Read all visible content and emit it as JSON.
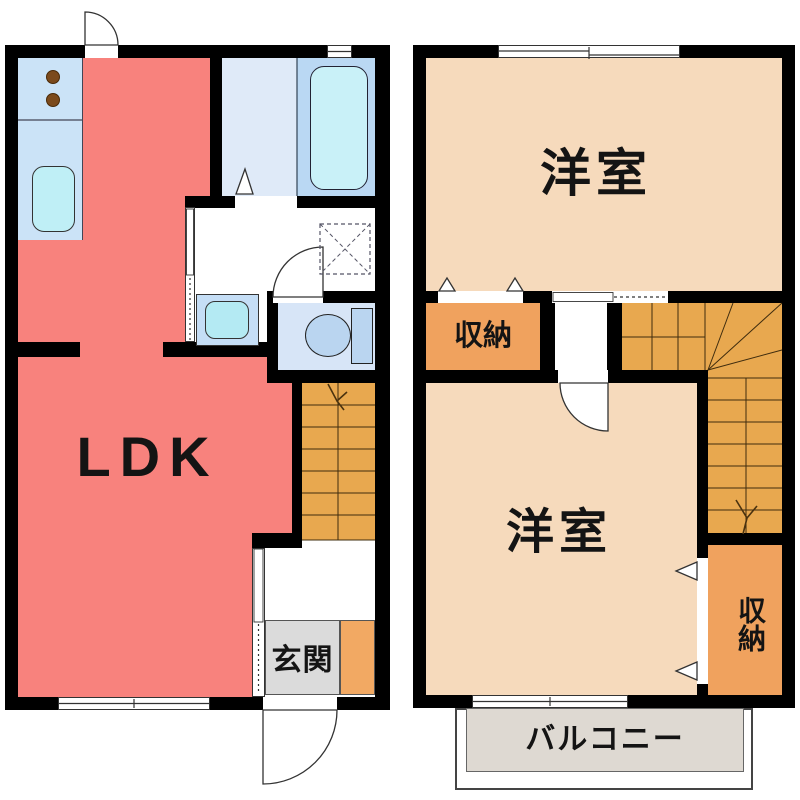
{
  "meta": {
    "diagram_type": "floor-plan",
    "floors": 2,
    "style": "japanese-real-estate"
  },
  "labels": {
    "ldk": "LDK",
    "genkan": "玄関",
    "room2f_upper": "洋室",
    "room2f_lower": "洋室",
    "closet_upper": "収納",
    "closet_lower": "収納",
    "balcony": "バルコニー"
  },
  "colors": {
    "wall": "#000000",
    "ldk": "#f8827d",
    "western_room": "#f6dabc",
    "closet": "#f0a25e",
    "stairs": "#e8a84f",
    "kitchen_counter": "#cbe3f7",
    "sink": "#bfeff6",
    "bath_floor": "#dfeaf8",
    "bath_tub_area": "#bad8f3",
    "tub": "#c9f1f8",
    "toilet_room": "#d7e5f7",
    "fixture_blue": "#bad5f0",
    "vanity": "#c5def6",
    "basin": "#b4eaf3",
    "genkan": "#dbdbdb",
    "shoe_cabinet": "#f2a963",
    "balcony": "#ded9d2",
    "burner": "#7b4a1c"
  },
  "icons": [
    "stove-burner-icon",
    "kitchen-sink-icon",
    "bathtub-icon",
    "folding-door-icon",
    "washer-pan-icon",
    "vanity-basin-icon",
    "toilet-icon",
    "door-swing-icon",
    "sliding-door-icon",
    "sliding-window-icon",
    "staircase-icon",
    "stair-direction-arrow-icon"
  ]
}
